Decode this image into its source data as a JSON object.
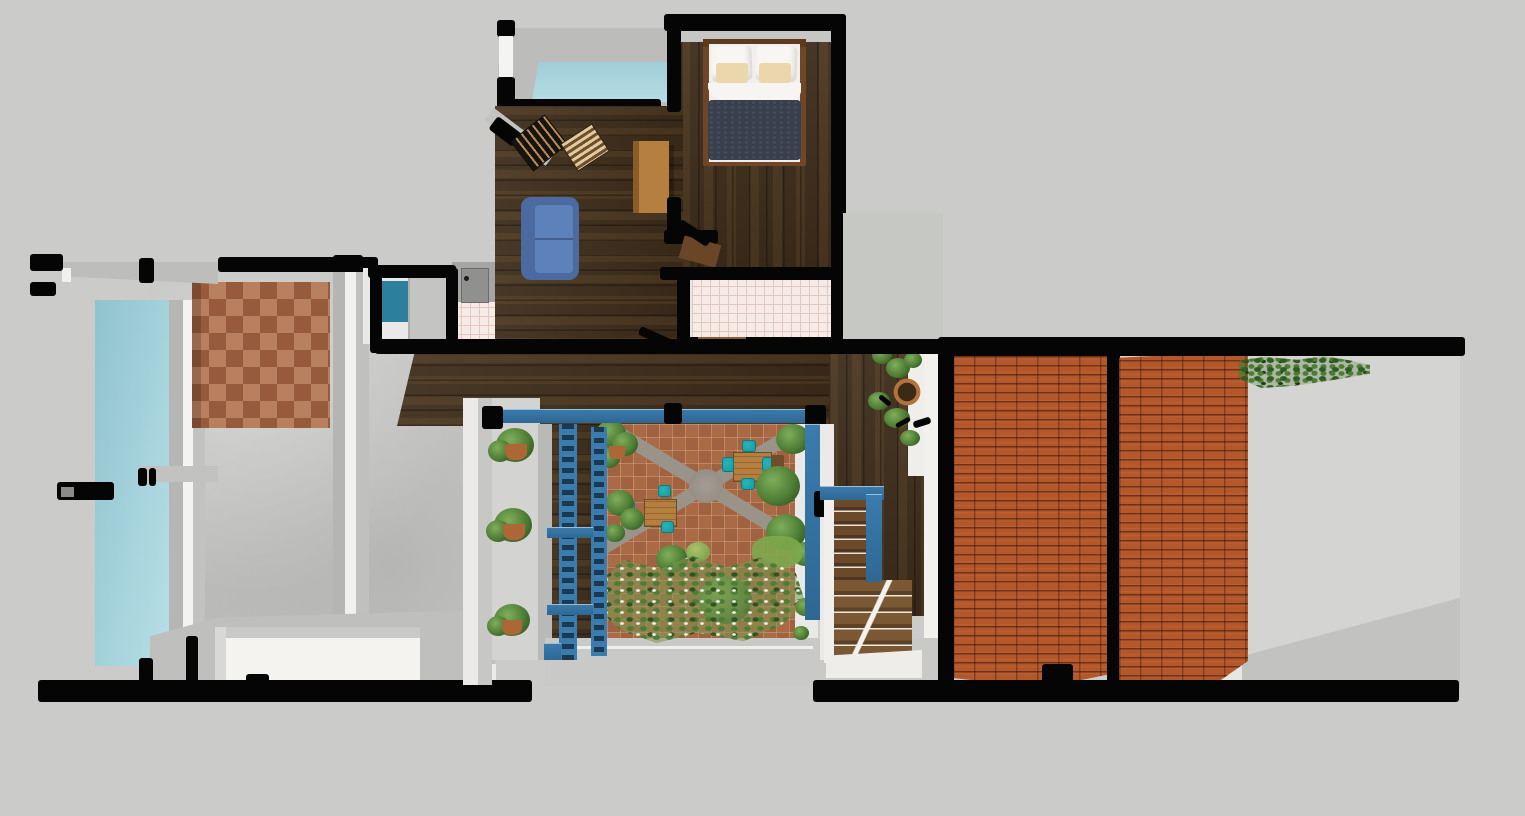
{
  "meta": {
    "kind": "3d-floorplan-render",
    "width": 1525,
    "height": 816,
    "visible_text": "none"
  },
  "palette": {
    "background": "#cbcbc9",
    "wall_black": "#050505",
    "concrete": "#c4c4c2",
    "deck_gray": "#bcbcba",
    "ledge_gray": "#b9b9b7",
    "white_wall": "#efeeeb",
    "glass_blue": "#a6d1da",
    "glass_teal": "#2c7f9d",
    "pool_blue": "#a9d3dd",
    "wood_dark": "#3e2d1b",
    "wood_light": "#b5803f",
    "wood_frame": "#6f4727",
    "terracotta": "#a86845",
    "courtyard_tile": "#aa6a46",
    "path_gray": "#99938a",
    "brick": "#b4582c",
    "steel_blue": "#3a7cae",
    "teal_chair": "#18a0a8",
    "sofa_blue": "#4a6aa0",
    "sofa_seat": "#5d82bb",
    "duvet_navy": "#39404d",
    "pillow_white": "#f7f6f3",
    "pillow_cream": "#ecd7ac",
    "bath_tile": "#f7ebe8",
    "bath_grout": "#e3c8c2",
    "plant_green": "#4e7d35",
    "plant_dark": "#2f5420",
    "plant_light": "#7fae5a",
    "pot_clay": "#ad6636"
  },
  "scene": {
    "upper_wing": [
      "pool-terrace",
      "plunge-pool",
      "bedroom",
      "double-bed",
      "living-room",
      "blue-sofa",
      "wood-desk",
      "striped-mat",
      "ladder",
      "bathroom-pink-tile",
      "kitchen-counter-sink"
    ],
    "left_wing": [
      "glass-facade",
      "concrete-floor",
      "terracotta-checker-rug",
      "white-planter-basin",
      "cantilever-beam"
    ],
    "courtyard": [
      "terracotta-paving",
      "diagonal-gray-paths",
      "center-hub",
      "dining-set-1",
      "dining-set-2",
      "potted-plants",
      "ground-cover",
      "blue-trellis-frames",
      "blue-pergola-beam"
    ],
    "right_wing": [
      "stair-hall",
      "wood-stairs",
      "blue-stair-railing",
      "hanging-plant",
      "brick-wall-panel-1",
      "brick-wall-panel-2",
      "vine-on-wall",
      "gray-patio"
    ]
  }
}
